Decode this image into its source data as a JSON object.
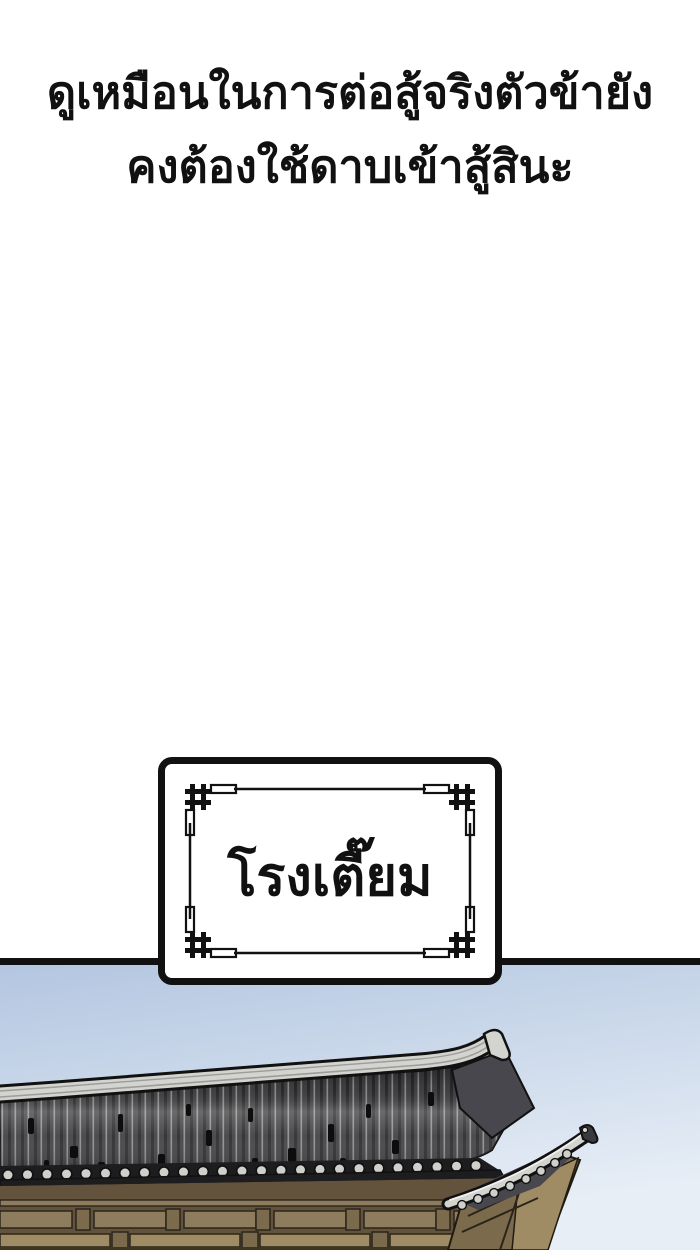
{
  "page": {
    "kind": "comic-panel",
    "background": "#ffffff"
  },
  "narration": {
    "line1": "ดูเหมือนในการต่อสู้จริงตัวข้ายัง",
    "line2": "คงต้องใช้ดาบเข้าสู้สินะ"
  },
  "sign": {
    "label": "โรงเตี๊ยม"
  },
  "scene": {
    "label": "traditional-inn-roof-against-sky",
    "colors": {
      "ink": "#111111",
      "sky-top": "#b2c5e0",
      "sky-bottom": "#e7eef6",
      "ridge": "#d3d3cf",
      "ridge-shade": "#9c9c98",
      "tile-dark": "#414143",
      "tile-line": "#8f8f91",
      "tile-end": "#cfcfcb",
      "eave-dark": "#1d1d1f",
      "under-eave": "#47474d",
      "wood-dark": "#63533c",
      "wood-mid": "#7c6a4c",
      "wood-light": "#a08c64",
      "wood-panel": "#8d7c5e"
    }
  }
}
